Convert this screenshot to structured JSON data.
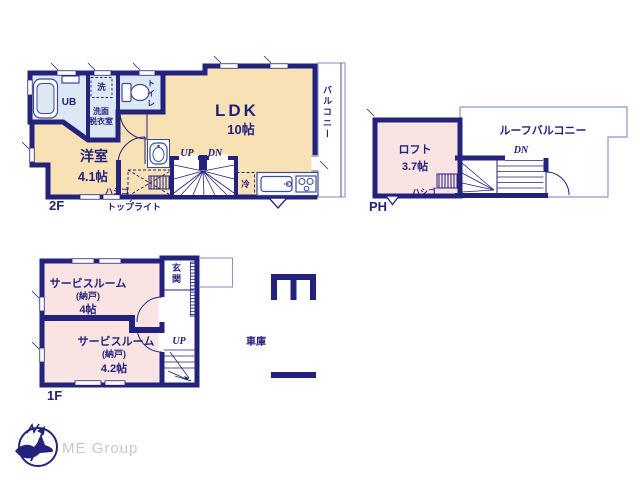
{
  "palette": {
    "wall_navy": "#23237d",
    "room_cream": "#f7e1b5",
    "wet_blue": "#dce9f5",
    "room_pink": "#f9e3e3",
    "fixture_line": "#3c4a9a",
    "light_line": "#8b97c4",
    "brand_gray": "#c8c8c8"
  },
  "f2": {
    "label": "2F",
    "ldk": "LDK",
    "ldk_size": "10帖",
    "room_name": "洋室",
    "room_size": "4.1帖",
    "ub": "UB",
    "washer": "洗",
    "washroom1": "洗面",
    "washroom2": "脱衣室",
    "toilet": "トイレ",
    "balcony": "バルコニー",
    "up": "UP",
    "dn": "DN",
    "fridge": "冷",
    "ladder": "ハシゴ",
    "skylight": "トップライト"
  },
  "ph": {
    "label": "PH",
    "loft_name": "ロフト",
    "loft_size": "3.7帖",
    "roof_balcony": "ルーフバルコニー",
    "dn": "DN",
    "ladder": "ハシゴ"
  },
  "f1": {
    "label": "1F",
    "service1_name": "サービスルーム",
    "service1_tag": "(納戸)",
    "service1_size": "4帖",
    "service2_name": "サービスルーム",
    "service2_tag": "(納戸)",
    "service2_size": "4.2帖",
    "entrance": "玄関",
    "up": "UP",
    "garage": "車庫"
  },
  "brand": {
    "name": "ME Group"
  }
}
